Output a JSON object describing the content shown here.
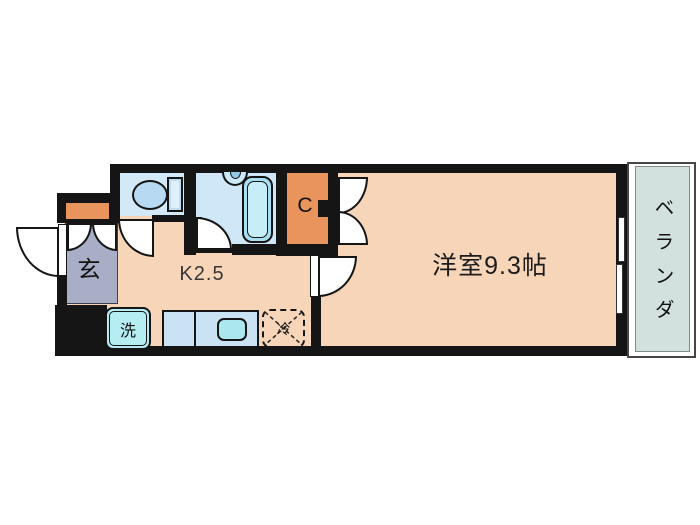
{
  "floorplan": {
    "title": "apartment-floor-plan",
    "rooms": {
      "entrance": {
        "label": "玄"
      },
      "kitchen": {
        "label": "K2.5"
      },
      "main_room": {
        "label": "洋室9.3帖"
      },
      "closet": {
        "label": "C"
      },
      "veranda": {
        "label": "ベランダ"
      }
    },
    "fixtures": {
      "washer": {
        "label": "洗"
      },
      "refrigerator": {
        "label": "冷"
      }
    },
    "colors": {
      "floor_peach": "#f6d5b8",
      "closet_orange": "#e8945c",
      "entrance_gray": "#a8aec6",
      "wet_room_blue": "#d4e9f8",
      "bathtub_cyan": "#a9e0f1",
      "counter_blue": "#c9e2f4",
      "appliance_cyan": "#b6edf3",
      "veranda_gray": "#d2e0de",
      "wall_black": "#151515",
      "background": "#ffffff"
    }
  }
}
